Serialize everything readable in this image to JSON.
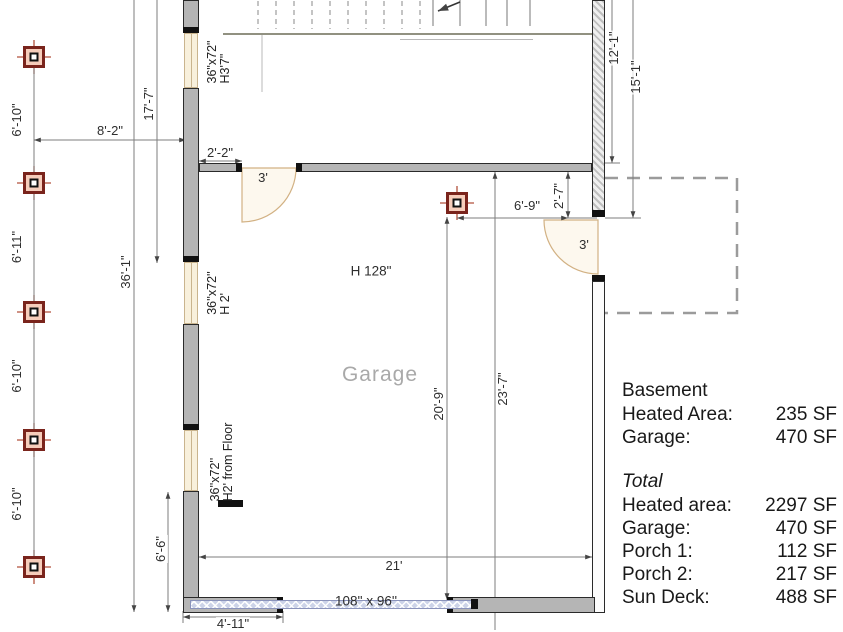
{
  "plan": {
    "room_label": "Garage",
    "ceiling_height": "H 128\"",
    "garage_door_size": "108'' x 96''",
    "doors": {
      "interior_width": "3'",
      "side_width": "3'"
    },
    "windows": [
      {
        "size": "36\"x72\"",
        "note": "H3'7\""
      },
      {
        "size": "36''x72''",
        "note": "H 2'"
      },
      {
        "size": "36''x72''",
        "note": "H2' from Floor"
      }
    ],
    "dims": {
      "col1": "6'-10\"",
      "col2": "6'-11\"",
      "col3": "6'-10\"",
      "col4": "6'-10\"",
      "w8_2": "8'-2\"",
      "w17_7": "17'-7\"",
      "w2_2": "2'-2\"",
      "w36_1": "36'-1\"",
      "w6_6": "6'-6\"",
      "w4_11": "4'-11\"",
      "w21": "21'",
      "w20_9": "20'-9\"",
      "w23_7": "23'-7\"",
      "w6_9": "6'-9\"",
      "w2_7": "2'-7\"",
      "w12_1": "12'-1\"",
      "w15_1": "15'-1\""
    }
  },
  "summary": {
    "basement": {
      "title": "Basement",
      "rows": [
        {
          "label": "Heated Area:",
          "value": "235 SF"
        },
        {
          "label": "Garage:",
          "value": "470 SF"
        }
      ]
    },
    "total": {
      "title": "Total",
      "rows": [
        {
          "label": "Heated area:",
          "value": "2297 SF"
        },
        {
          "label": "Garage:",
          "value": "470 SF"
        },
        {
          "label": "Porch 1:",
          "value": "112 SF"
        },
        {
          "label": "Porch 2:",
          "value": "217 SF"
        },
        {
          "label": "Sun Deck:",
          "value": "488 SF"
        }
      ]
    }
  },
  "colors": {
    "wall_gray": "#b5b5b5",
    "column_red": "#7a241c",
    "window_cream": "#f8f0dc",
    "garage_door_blue": "#ccd3e8",
    "deck_dash_gray": "#9b9b9b"
  }
}
